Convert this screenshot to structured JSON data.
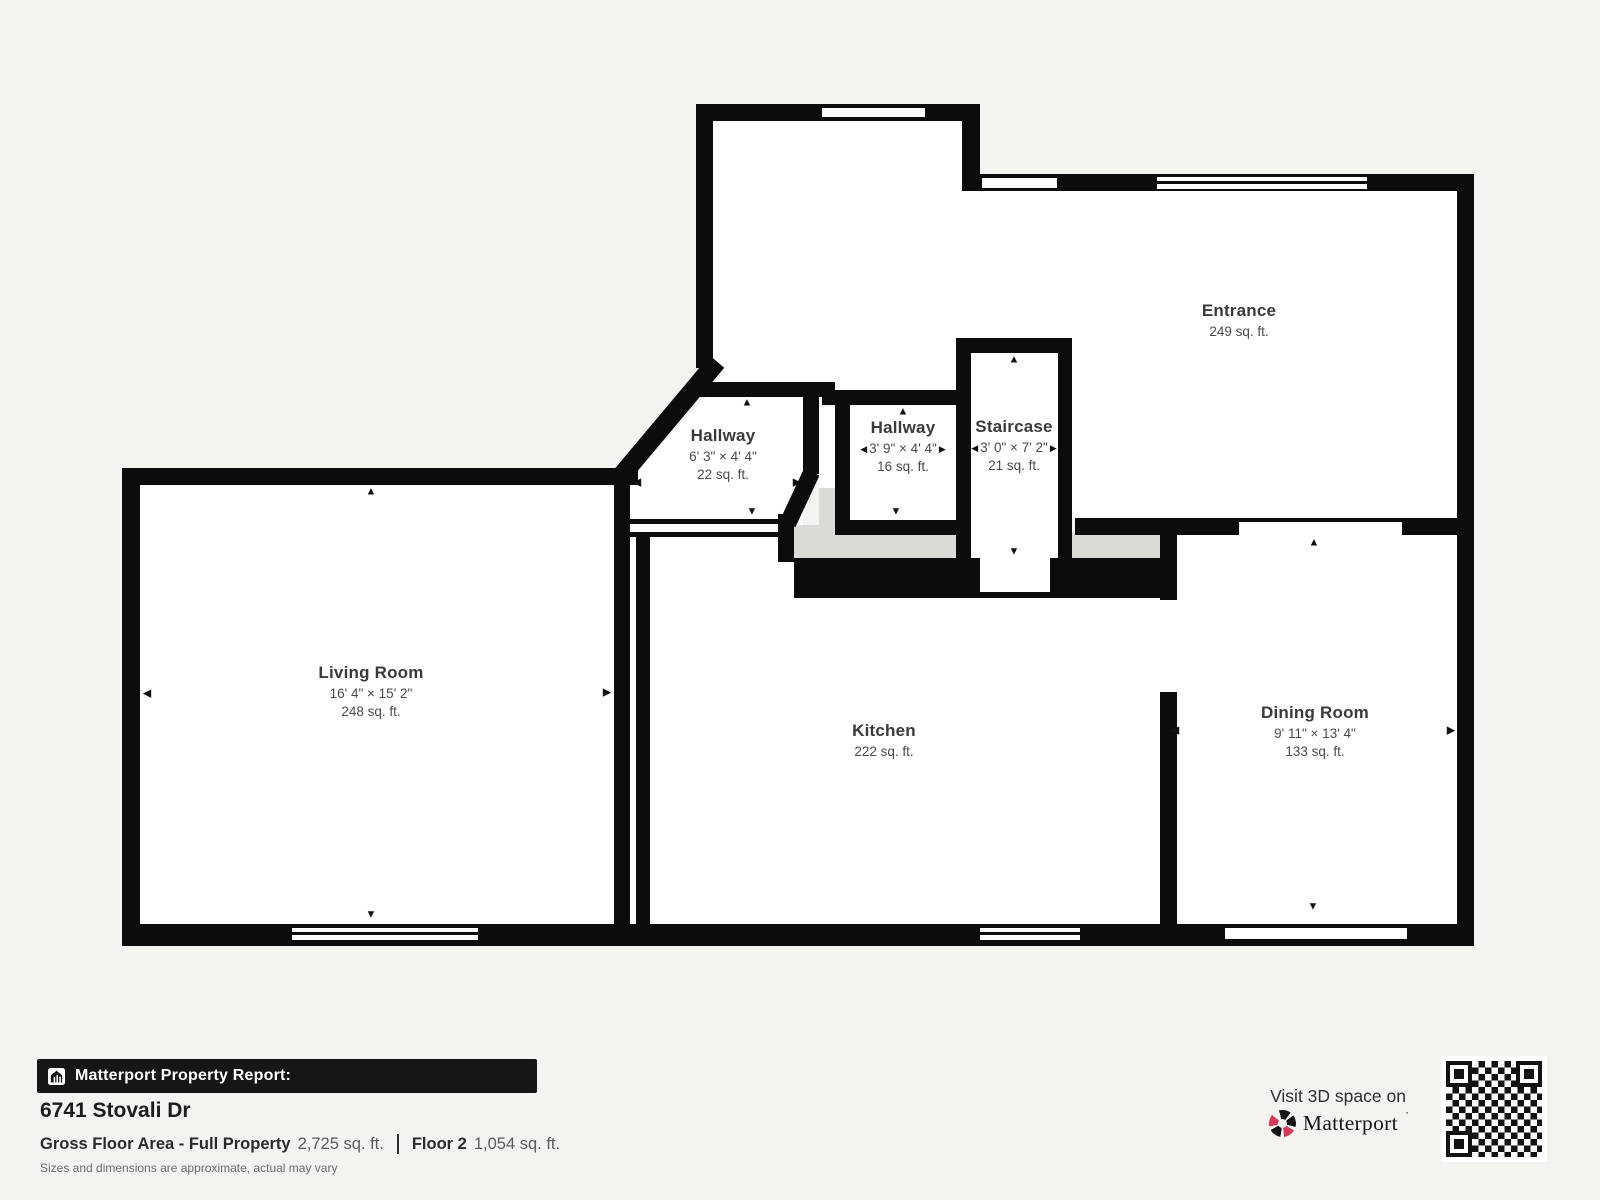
{
  "colors": {
    "background": "#f4f3f0",
    "wall": "#0c0c0c",
    "floor": "#ffffff",
    "interior_gray": "#dbdad7",
    "accent_pink": "#d63b5e",
    "footer_bar": "#171614"
  },
  "icons": {
    "arrow_up": "▲",
    "arrow_down": "▼",
    "arrow_left": "◀",
    "arrow_right": "▶"
  },
  "floorplan": {
    "rooms": [
      {
        "name": "Entrance",
        "dims": "",
        "area": "249 sq. ft."
      },
      {
        "name": "Hallway",
        "dims": "6' 3\" × 4' 4\"",
        "area": "22 sq. ft."
      },
      {
        "name": "Hallway",
        "dims": "3' 9\" × 4' 4\"",
        "area": "16 sq. ft."
      },
      {
        "name": "Staircase",
        "dims": "3' 0\" × 7' 2\"",
        "area": "21 sq. ft."
      },
      {
        "name": "Living Room",
        "dims": "16' 4\" × 15' 2\"",
        "area": "248 sq. ft."
      },
      {
        "name": "Kitchen",
        "dims": "",
        "area": "222 sq. ft."
      },
      {
        "name": "Dining Room",
        "dims": "9' 11\" × 13' 4\"",
        "area": "133 sq. ft."
      }
    ]
  },
  "report": {
    "bar_title": "Matterport Property Report:",
    "address": "6741 Stovali Dr",
    "gross_label": "Gross Floor Area - Full Property",
    "gross_value": "2,725 sq. ft.",
    "floor_label": "Floor 2",
    "floor_value": "1,054 sq. ft.",
    "disclaimer": "Sizes and dimensions are approximate, actual may vary"
  },
  "cta": {
    "visit_text": "Visit 3D space on",
    "brand": "Matterport"
  }
}
